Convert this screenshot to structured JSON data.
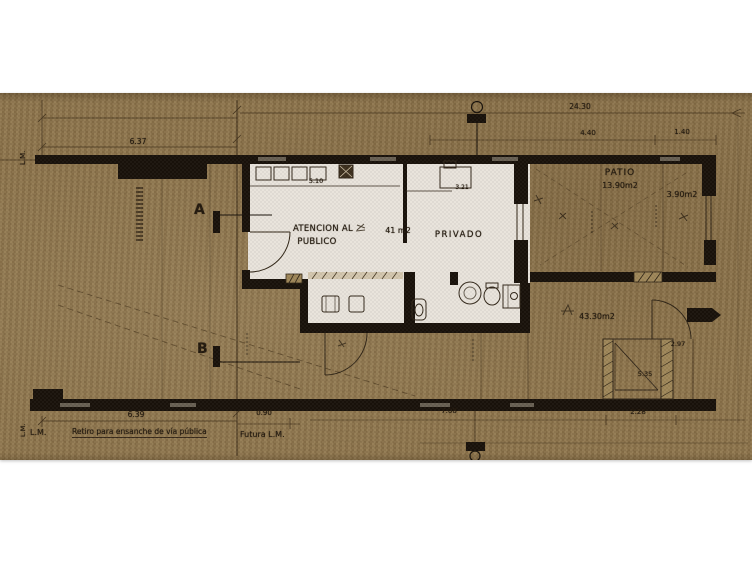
{
  "labels": {
    "lm_top_left": "L.M.",
    "lm_bottom_left": "L.M.",
    "lm_bottom": "L.M.",
    "section_a": "A",
    "section_b": "B",
    "atencion_line1": "ATENCION AL",
    "atencion_line2": "PUBLICO",
    "atencion_area": "41 m2",
    "privado": "PRIVADO",
    "patio": "PATIO",
    "patio_area": "13.90m2",
    "strip_area": "3.90m2",
    "yard_area": "43.30m2",
    "retiro": "Retiro para ensanche de vía pública",
    "futura_lm": "Futura L.M."
  },
  "dimensions": {
    "top_left_width": "6.37",
    "overall_width": "24.30",
    "patio_width": "4.40",
    "strip_width": "1.40",
    "room_width": "5.10",
    "private_width": "3.21",
    "bottom_left_width": "6.39",
    "bottom_offset": "0.90",
    "bottom_center": "7.08",
    "tank_width": "2.28",
    "tank_side": "2.97",
    "tank_inner": "5.35"
  },
  "colors": {
    "paper": "#8c744c",
    "floor": "#e8e4dd",
    "wall": "#161009",
    "ink": "#2e2416"
  }
}
